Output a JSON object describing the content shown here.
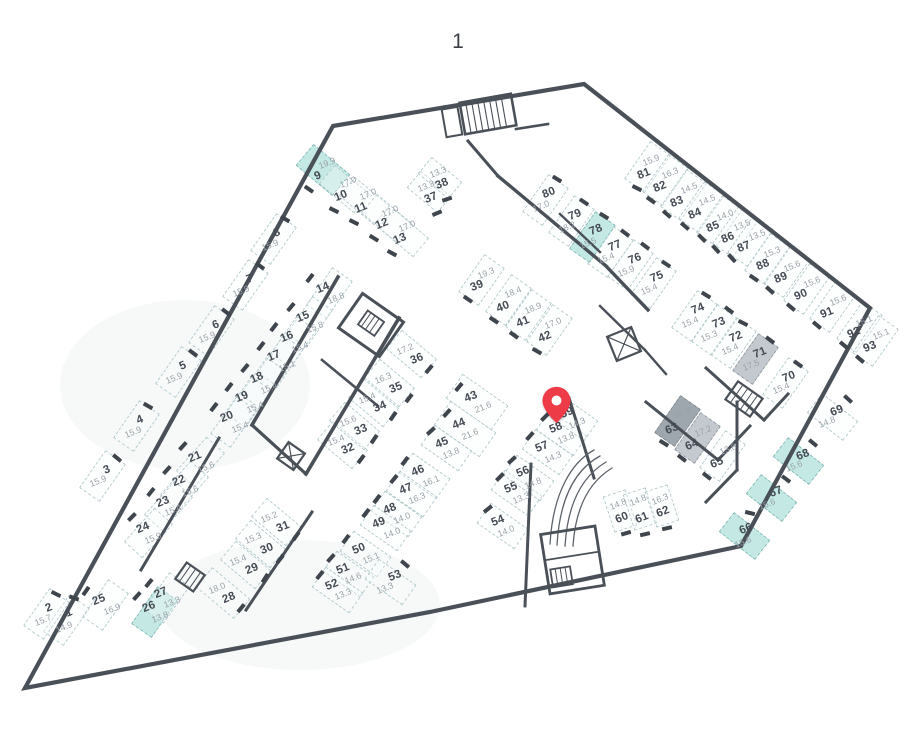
{
  "page": {
    "title": "1"
  },
  "pin": {
    "marked_space": "59",
    "color": "#ee3b48"
  },
  "colors": {
    "highlight_teal": "#bfe7e3",
    "highlight_gray": "#b9bfc5",
    "wall": "#4a5057"
  },
  "stalls": [
    {
      "num": "1",
      "area": "14.9",
      "highlight": null
    },
    {
      "num": "2",
      "area": "15.7",
      "highlight": null
    },
    {
      "num": "3",
      "area": "15.9",
      "highlight": null
    },
    {
      "num": "4",
      "area": "15.9",
      "highlight": null
    },
    {
      "num": "5",
      "area": "15.9",
      "highlight": null
    },
    {
      "num": "6",
      "area": "15.9",
      "highlight": null
    },
    {
      "num": "7",
      "area": "15.9",
      "highlight": null
    },
    {
      "num": "8",
      "area": "15.9",
      "highlight": null
    },
    {
      "num": "9",
      "area": "19.9",
      "highlight": "teal"
    },
    {
      "num": "10",
      "area": "17.0",
      "highlight": null
    },
    {
      "num": "11",
      "area": "17.0",
      "highlight": null
    },
    {
      "num": "12",
      "area": "17.0",
      "highlight": null
    },
    {
      "num": "13",
      "area": "17.0",
      "highlight": null
    },
    {
      "num": "14",
      "area": "18.8",
      "highlight": null
    },
    {
      "num": "15",
      "area": "15.8",
      "highlight": null
    },
    {
      "num": "16",
      "area": "15.4",
      "highlight": null
    },
    {
      "num": "17",
      "area": "15.1",
      "highlight": null
    },
    {
      "num": "18",
      "area": "15.4",
      "highlight": null
    },
    {
      "num": "19",
      "area": "15.4",
      "highlight": null
    },
    {
      "num": "20",
      "area": "15.4",
      "highlight": null
    },
    {
      "num": "21",
      "area": "15.6",
      "highlight": null
    },
    {
      "num": "22",
      "area": "15.6",
      "highlight": null
    },
    {
      "num": "23",
      "area": "15.4",
      "highlight": null
    },
    {
      "num": "24",
      "area": "15.9",
      "highlight": null
    },
    {
      "num": "25",
      "area": "16.9",
      "highlight": null
    },
    {
      "num": "26",
      "area": "13.8",
      "highlight": "teal"
    },
    {
      "num": "27",
      "area": "13.3",
      "highlight": null
    },
    {
      "num": "28",
      "area": "18.0",
      "highlight": null
    },
    {
      "num": "29",
      "area": "15.4",
      "highlight": null
    },
    {
      "num": "30",
      "area": "15.3",
      "highlight": null
    },
    {
      "num": "31",
      "area": "15.2",
      "highlight": null
    },
    {
      "num": "32",
      "area": "15.4",
      "highlight": null
    },
    {
      "num": "33",
      "area": "15.6",
      "highlight": null
    },
    {
      "num": "34",
      "area": "15.4",
      "highlight": null
    },
    {
      "num": "35",
      "area": "16.3",
      "highlight": null
    },
    {
      "num": "36",
      "area": "17.2",
      "highlight": null
    },
    {
      "num": "37",
      "area": "13.3",
      "highlight": null
    },
    {
      "num": "38",
      "area": "13.3",
      "highlight": null
    },
    {
      "num": "39",
      "area": "19.3",
      "highlight": null
    },
    {
      "num": "40",
      "area": "18.4",
      "highlight": null
    },
    {
      "num": "41",
      "area": "18.9",
      "highlight": null
    },
    {
      "num": "42",
      "area": "17.0",
      "highlight": null
    },
    {
      "num": "43",
      "area": "21.6",
      "highlight": null
    },
    {
      "num": "44",
      "area": "21.6",
      "highlight": null
    },
    {
      "num": "45",
      "area": "13.8",
      "highlight": null
    },
    {
      "num": "46",
      "area": "16.1",
      "highlight": null
    },
    {
      "num": "47",
      "area": "16.3",
      "highlight": null
    },
    {
      "num": "48",
      "area": "14.0",
      "highlight": null
    },
    {
      "num": "49",
      "area": "14.0",
      "highlight": null
    },
    {
      "num": "50",
      "area": "15.1",
      "highlight": null
    },
    {
      "num": "51",
      "area": "14.6",
      "highlight": null
    },
    {
      "num": "52",
      "area": "13.3",
      "highlight": null
    },
    {
      "num": "53",
      "area": "13.3",
      "highlight": null
    },
    {
      "num": "54",
      "area": "14.0",
      "highlight": null
    },
    {
      "num": "55",
      "area": "13.3",
      "highlight": null
    },
    {
      "num": "56",
      "area": "14.8",
      "highlight": null
    },
    {
      "num": "57",
      "area": "14.3",
      "highlight": null
    },
    {
      "num": "58",
      "area": "13.8",
      "highlight": null
    },
    {
      "num": "59",
      "area": "14.3",
      "highlight": null
    },
    {
      "num": "60",
      "area": "14.8",
      "highlight": null
    },
    {
      "num": "61",
      "area": "14.8",
      "highlight": null
    },
    {
      "num": "62",
      "area": "16.3",
      "highlight": null
    },
    {
      "num": "63",
      "area": "16.8",
      "highlight": "gray-dark"
    },
    {
      "num": "64",
      "area": "17.2",
      "highlight": "gray"
    },
    {
      "num": "65",
      "area": "13.8",
      "highlight": null
    },
    {
      "num": "66",
      "area": "15.6",
      "highlight": "teal"
    },
    {
      "num": "67",
      "area": "15.6",
      "highlight": "teal"
    },
    {
      "num": "68",
      "area": "15.6",
      "highlight": "teal"
    },
    {
      "num": "69",
      "area": "14.8",
      "highlight": null
    },
    {
      "num": "70",
      "area": "15.4",
      "highlight": null
    },
    {
      "num": "71",
      "area": "17.5",
      "highlight": "gray"
    },
    {
      "num": "72",
      "area": "15.4",
      "highlight": null
    },
    {
      "num": "73",
      "area": "15.3",
      "highlight": null
    },
    {
      "num": "74",
      "area": "15.4",
      "highlight": null
    },
    {
      "num": "75",
      "area": "15.4",
      "highlight": null
    },
    {
      "num": "76",
      "area": "15.9",
      "highlight": null
    },
    {
      "num": "77",
      "area": "15.4",
      "highlight": null
    },
    {
      "num": "78",
      "area": "15.5",
      "highlight": "teal"
    },
    {
      "num": "79",
      "area": "18.2",
      "highlight": null
    },
    {
      "num": "80",
      "area": "17.0",
      "highlight": null
    },
    {
      "num": "81",
      "area": "15.9",
      "highlight": null
    },
    {
      "num": "82",
      "area": "16.3",
      "highlight": null
    },
    {
      "num": "83",
      "area": "14.5",
      "highlight": null
    },
    {
      "num": "84",
      "area": "14.5",
      "highlight": null
    },
    {
      "num": "85",
      "area": "14.0",
      "highlight": null
    },
    {
      "num": "86",
      "area": "13.5",
      "highlight": null
    },
    {
      "num": "87",
      "area": "13.5",
      "highlight": null
    },
    {
      "num": "88",
      "area": "15.3",
      "highlight": null
    },
    {
      "num": "89",
      "area": "15.6",
      "highlight": null
    },
    {
      "num": "90",
      "area": "15.6",
      "highlight": null
    },
    {
      "num": "91",
      "area": "15.6",
      "highlight": null
    },
    {
      "num": "92",
      "area": "15.1",
      "highlight": null
    },
    {
      "num": "93",
      "area": "15.1",
      "highlight": null
    }
  ]
}
